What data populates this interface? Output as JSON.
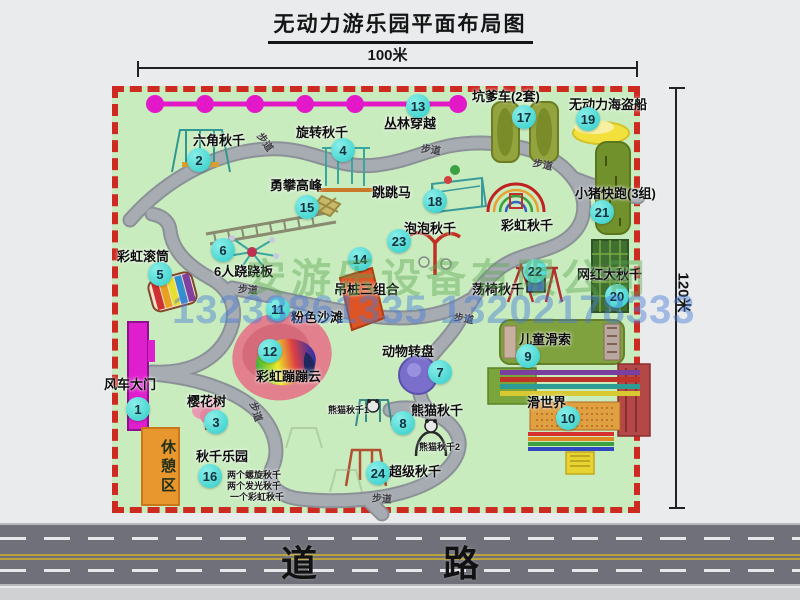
{
  "title": "无动力游乐园平面布局图",
  "dimensions": {
    "top": "100米",
    "right": "120米"
  },
  "road": {
    "label": "道 路"
  },
  "watermark": {
    "company": "安游乐设备有限公司",
    "phone": "13233861335 13202178333"
  },
  "rest_area": {
    "label": "休憩区"
  },
  "path_label_text": "步道",
  "colors": {
    "park_green": "#c9ecbf",
    "border_red": "#cd2a22",
    "badge_cyan": "#2fcdc9",
    "gate_magenta": "#df1fce",
    "zipline_magenta": "#e318c8",
    "path_gray": "#9aa0a6",
    "road_gray": "#70707a",
    "rest_area_orange": "#e8962e",
    "pirate_ship_yellow": "#f2e13c",
    "turntable_purple": "#7a70cc",
    "hanging_pile_orange": "#dd5526"
  },
  "attractions": [
    {
      "num": "1",
      "name": "风车大门",
      "label": {
        "x": 104,
        "y": 374
      },
      "badge": {
        "x": 126,
        "y": 397
      }
    },
    {
      "num": "2",
      "name": "六角秋千",
      "label": {
        "x": 193,
        "y": 130
      },
      "badge": {
        "x": 187,
        "y": 148
      }
    },
    {
      "num": "3",
      "name": "樱花树",
      "label": {
        "x": 187,
        "y": 391
      },
      "badge": {
        "x": 204,
        "y": 410
      }
    },
    {
      "num": "4",
      "name": "旋转秋千",
      "label": {
        "x": 296,
        "y": 122
      },
      "badge": {
        "x": 331,
        "y": 138
      }
    },
    {
      "num": "5",
      "name": "彩虹滚筒",
      "label": {
        "x": 117,
        "y": 246
      },
      "badge": {
        "x": 148,
        "y": 262
      }
    },
    {
      "num": "6",
      "name": "6人跷跷板",
      "label": {
        "x": 214,
        "y": 261
      },
      "badge": {
        "x": 211,
        "y": 238
      }
    },
    {
      "num": "7",
      "name": "动物转盘",
      "label": {
        "x": 382,
        "y": 341
      },
      "badge": {
        "x": 428,
        "y": 360
      }
    },
    {
      "num": "8",
      "name": "熊猫秋千",
      "label": {
        "x": 411,
        "y": 400
      },
      "badge": {
        "x": 391,
        "y": 411
      }
    },
    {
      "num": "9",
      "name": "儿童滑索",
      "label": {
        "x": 519,
        "y": 329
      },
      "badge": {
        "x": 516,
        "y": 344
      }
    },
    {
      "num": "10",
      "name": "滑世界",
      "label": {
        "x": 527,
        "y": 392
      },
      "badge": {
        "x": 556,
        "y": 406
      }
    },
    {
      "num": "11",
      "name": "粉色沙滩",
      "label": {
        "x": 291,
        "y": 307
      },
      "badge": {
        "x": 266,
        "y": 297
      }
    },
    {
      "num": "12",
      "name": "彩虹蹦蹦云",
      "label": {
        "x": 256,
        "y": 366
      },
      "badge": {
        "x": 258,
        "y": 339
      }
    },
    {
      "num": "13",
      "name": "丛林穿越",
      "label": {
        "x": 384,
        "y": 113
      },
      "badge": {
        "x": 406,
        "y": 94
      }
    },
    {
      "num": "14",
      "name": "吊桩三组合",
      "label": {
        "x": 334,
        "y": 279
      },
      "badge": {
        "x": 348,
        "y": 247
      }
    },
    {
      "num": "15",
      "name": "勇攀高峰",
      "label": {
        "x": 270,
        "y": 175
      },
      "badge": {
        "x": 295,
        "y": 195
      }
    },
    {
      "num": "16",
      "name": "秋千乐园",
      "label": {
        "x": 196,
        "y": 446
      },
      "badge": {
        "x": 198,
        "y": 464
      }
    },
    {
      "num": "17",
      "name": "坑爹车(2套)",
      "label": {
        "x": 472,
        "y": 86
      },
      "badge": {
        "x": 512,
        "y": 105
      }
    },
    {
      "num": "18",
      "name": "跳跳马",
      "label": {
        "x": 372,
        "y": 182
      },
      "badge": {
        "x": 423,
        "y": 189
      }
    },
    {
      "num": "19",
      "name": "无动力海盗船",
      "label": {
        "x": 569,
        "y": 94
      },
      "badge": {
        "x": 576,
        "y": 107
      }
    },
    {
      "num": "20",
      "name": "网红大秋千",
      "label": {
        "x": 577,
        "y": 264
      },
      "badge": {
        "x": 605,
        "y": 284
      }
    },
    {
      "num": "21",
      "name": "小猪快跑(3组)",
      "label": {
        "x": 575,
        "y": 183
      },
      "badge": {
        "x": 590,
        "y": 200
      }
    },
    {
      "num": "22",
      "name": "荡椅秋千",
      "label": {
        "x": 472,
        "y": 279
      },
      "badge": {
        "x": 523,
        "y": 259
      }
    },
    {
      "num": "23",
      "name": "泡泡秋千",
      "label": {
        "x": 404,
        "y": 218
      },
      "badge": {
        "x": 387,
        "y": 229
      }
    },
    {
      "num": "24",
      "name": "超级秋千",
      "label": {
        "x": 389,
        "y": 461
      },
      "badge": {
        "x": 366,
        "y": 461
      }
    }
  ],
  "extra_labels": [
    {
      "text": "彩虹秋千",
      "x": 501,
      "y": 215,
      "small": false
    },
    {
      "text": "熊猫秋千1",
      "x": 328,
      "y": 403,
      "small": true
    },
    {
      "text": "熊猫秋千2",
      "x": 419,
      "y": 440,
      "small": true
    },
    {
      "text": "两个螺旋秋千",
      "x": 227,
      "y": 468,
      "small": true
    },
    {
      "text": "两个发光秋千",
      "x": 227,
      "y": 479,
      "small": true
    },
    {
      "text": "一个彩虹秋千",
      "x": 230,
      "y": 490,
      "small": true
    }
  ],
  "path_labels": [
    {
      "x": 256,
      "y": 134,
      "rot": 55
    },
    {
      "x": 421,
      "y": 141,
      "rot": 8
    },
    {
      "x": 533,
      "y": 156,
      "rot": 12
    },
    {
      "x": 238,
      "y": 281,
      "rot": 4
    },
    {
      "x": 454,
      "y": 310,
      "rot": 10
    },
    {
      "x": 247,
      "y": 404,
      "rot": 72
    },
    {
      "x": 372,
      "y": 490,
      "rot": 4
    }
  ]
}
